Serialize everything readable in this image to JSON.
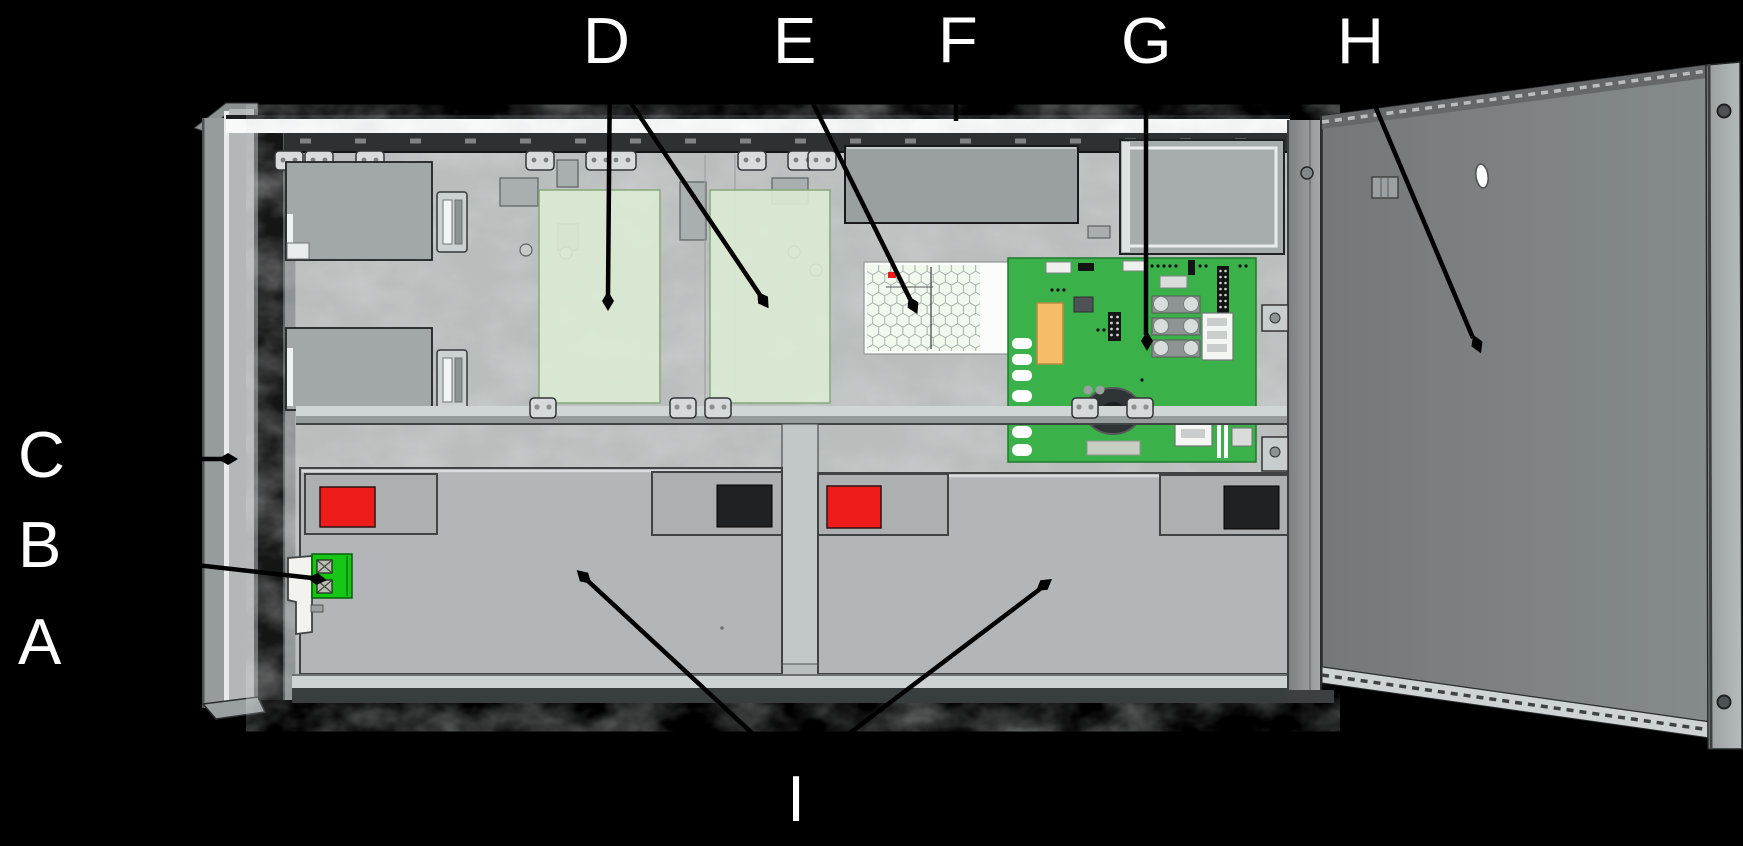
{
  "callout_letters": {
    "a": "A",
    "b": "B",
    "c": "C",
    "d": "D",
    "e": "E",
    "f": "F",
    "g": "G",
    "h": "H",
    "i": "I"
  },
  "colors": {
    "background": "#000000",
    "label_white": "#ffffff",
    "cabinet_panel_gray": "#b9bdbc",
    "door_gray": "#7e8283",
    "pcb_green": "#3bb14a",
    "option_area_green": "#dcebd4",
    "grille_white": "#fbfdfb",
    "battery_gray": "#b3b6b8",
    "positive_marker_red": "#ee1b1b",
    "negative_marker_black": "#1f2222",
    "terminal_block_green": "#15c615",
    "pcb_coil_orange": "#f6bc66",
    "callout_line_black": "#000000"
  }
}
